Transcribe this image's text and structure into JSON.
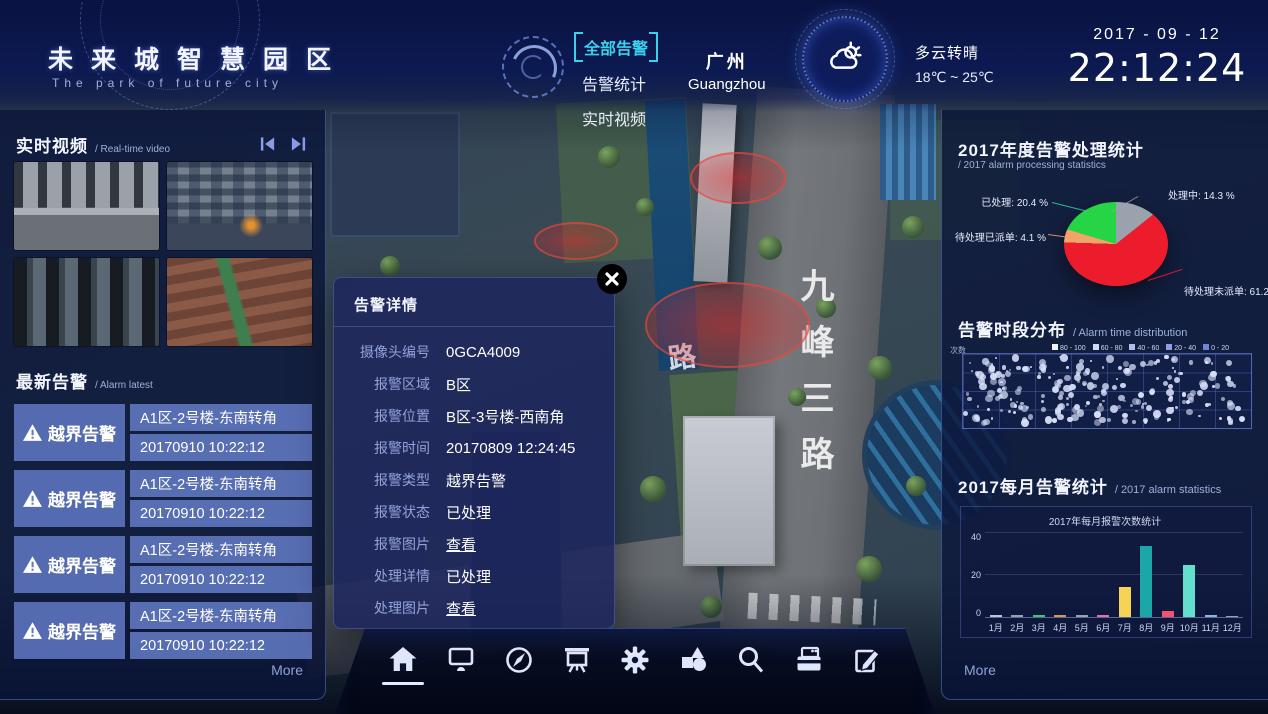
{
  "header": {
    "logo_title": "未来城智慧园区",
    "logo_subtitle": "The park of future city",
    "nav": [
      {
        "label": "全部告警",
        "active": true
      },
      {
        "label": "告警统计",
        "active": false
      },
      {
        "label": "实时视频",
        "active": false
      }
    ],
    "city_zh": "广州",
    "city_en": "Guangzhou",
    "weather_condition": "多云转晴",
    "weather_range": "18℃ ~ 25℃",
    "date": "2017 - 09 - 12",
    "time": "22:12:24"
  },
  "left_panel": {
    "video_title_zh": "实时视频",
    "video_title_en": "/ Real-time video",
    "alarm_title_zh": "最新告警",
    "alarm_title_en": "/ Alarm latest",
    "alarms": [
      {
        "type": "越界告警",
        "location": "A1区-2号楼-东南转角",
        "time": "20170910 10:22:12"
      },
      {
        "type": "越界告警",
        "location": "A1区-2号楼-东南转角",
        "time": "20170910 10:22:12"
      },
      {
        "type": "越界告警",
        "location": "A1区-2号楼-东南转角",
        "time": "20170910 10:22:12"
      },
      {
        "type": "越界告警",
        "location": "A1区-2号楼-东南转角",
        "time": "20170910 10:22:12"
      }
    ],
    "more_label": "More"
  },
  "modal": {
    "title": "告警详情",
    "fields": [
      {
        "label": "摄像头编号",
        "value": "0GCA4009",
        "link": false
      },
      {
        "label": "报警区域",
        "value": "B区",
        "link": false
      },
      {
        "label": "报警位置",
        "value": "B区-3号楼-西南角",
        "link": false
      },
      {
        "label": "报警时间",
        "value": "20170809 12:24:45",
        "link": false
      },
      {
        "label": "报警类型",
        "value": "越界告警",
        "link": false
      },
      {
        "label": "报警状态",
        "value": "已处理",
        "link": false
      },
      {
        "label": "报警图片",
        "value": "查看",
        "link": true
      },
      {
        "label": "处理详情",
        "value": "已处理",
        "link": false
      },
      {
        "label": "处理图片",
        "value": "查看",
        "link": true
      }
    ]
  },
  "right_panel": {
    "more_label": "More"
  },
  "chart_data": [
    {
      "type": "pie",
      "title": "2017年度告警处理统计",
      "subtitle": "/ 2017 alarm processing statistics",
      "slices": [
        {
          "name": "处理中",
          "value": 14.3,
          "color": "#9aa3ad",
          "label_text": "处理中: 14.3 %"
        },
        {
          "name": "待处理未派单",
          "value": 61.2,
          "color": "#ec1c2d",
          "label_text": "待处理未派单: 61.2 %"
        },
        {
          "name": "待处理已派单",
          "value": 4.1,
          "color": "#f2a469",
          "label_text": "待处理已派单: 4.1 %"
        },
        {
          "name": "已处理",
          "value": 20.4,
          "color": "#25d545",
          "label_text": "已处理: 20.4 %"
        }
      ]
    },
    {
      "type": "scatter",
      "title": "告警时段分布",
      "subtitle": "/ Alarm time distribution",
      "axis_label": "次数",
      "legend": [
        {
          "label": "80 - 100",
          "color": "#f0f4ff"
        },
        {
          "label": "60 - 80",
          "color": "#cfd9fa"
        },
        {
          "label": "40 - 60",
          "color": "#aebcf2"
        },
        {
          "label": "20 - 40",
          "color": "#8d9fe8"
        },
        {
          "label": "0 - 20",
          "color": "#6e84da"
        }
      ],
      "point_count": 230,
      "seed": 20170912,
      "grid": {
        "cols": 8,
        "rows": 4
      },
      "dot_color": "#d9e1fb"
    },
    {
      "type": "bar",
      "title": "2017每月告警统计",
      "subtitle": "/ 2017 alarm statistics",
      "inner_title": "2017年每月报警次数统计",
      "categories": [
        "1月",
        "2月",
        "3月",
        "4月",
        "5月",
        "6月",
        "7月",
        "8月",
        "9月",
        "10月",
        "11月",
        "12月"
      ],
      "values": [
        1,
        1,
        1,
        1,
        1,
        1,
        14,
        33,
        3,
        24,
        1,
        0.5
      ],
      "colors": [
        "#b9c6d4",
        "#97a2ae",
        "#3fc571",
        "#e2924f",
        "#9aa3ad",
        "#e070a8",
        "#f6d354",
        "#1ba7a7",
        "#f4516c",
        "#63e0cd",
        "#8fb6dc",
        "#9aa3ad"
      ],
      "ylim": [
        0,
        40
      ],
      "yticks": [
        0,
        20,
        40
      ],
      "xlabel": "",
      "ylabel": ""
    }
  ],
  "map": {
    "road_label": "九峰三路",
    "road_label_side": "路"
  },
  "toolbar": {
    "icons": [
      "home",
      "monitor",
      "compass",
      "projection-screen",
      "gear",
      "shapes",
      "search",
      "card-reader",
      "edit"
    ],
    "active": "home"
  }
}
